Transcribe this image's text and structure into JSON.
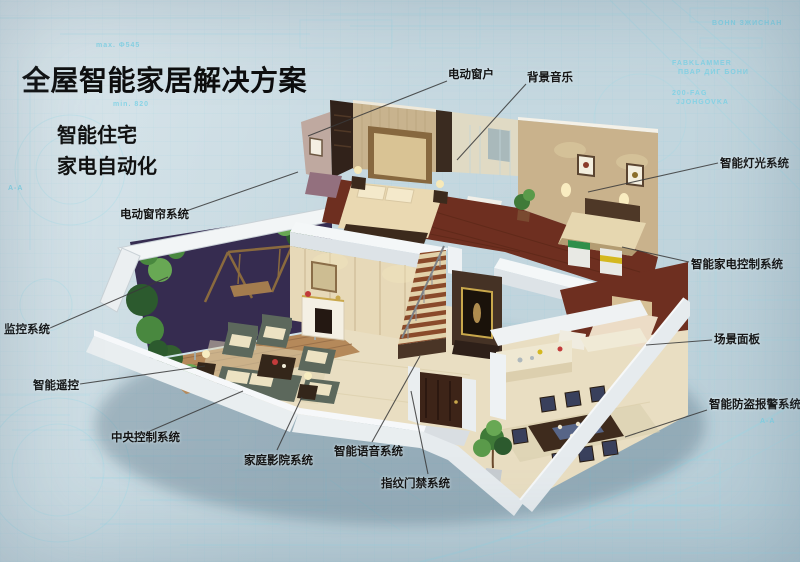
{
  "header": {
    "title": "全屋智能家居解决方案",
    "subtitle_line1": "智能住宅",
    "subtitle_line2": "家电自动化"
  },
  "callouts": [
    {
      "id": "electric-window",
      "label": "电动窗户"
    },
    {
      "id": "background-music",
      "label": "背景音乐"
    },
    {
      "id": "smart-lighting",
      "label": "智能灯光系统"
    },
    {
      "id": "smart-appliance-control",
      "label": "智能家电控制系统"
    },
    {
      "id": "scene-panel",
      "label": "场景面板"
    },
    {
      "id": "burglar-alarm",
      "label": "智能防盗报警系统"
    },
    {
      "id": "electric-curtain",
      "label": "电动窗帘系统"
    },
    {
      "id": "monitoring-system",
      "label": "监控系统"
    },
    {
      "id": "smart-remote",
      "label": "智能遥控"
    },
    {
      "id": "central-control",
      "label": "中央控制系统"
    },
    {
      "id": "home-theater",
      "label": "家庭影院系统"
    },
    {
      "id": "smart-voice",
      "label": "智能语音系统"
    },
    {
      "id": "fingerprint-access",
      "label": "指纹门禁系统"
    }
  ],
  "background": {
    "fragments": [
      "min. 820",
      "max. Φ545",
      "200-FAG",
      "A-A",
      "FABKLAMMER",
      "JJOHGOVKA",
      "BOHN ЗЖИСНАН",
      "ПВАР ДИГ БОНИ",
      "A-A"
    ]
  },
  "colors": {
    "background_base": "#c4d7df",
    "blueprint_line": "#9bdae8",
    "label_text": "#141414",
    "leader_line": "#3a3a3a",
    "wood_floor": "#6e2f20",
    "marble_floor": "#e9dec2",
    "wall_beige": "#c9b28c",
    "white_wall": "#eef1f3",
    "sofa_green": "#5c685c",
    "plant_green": "#49883f",
    "balcony_backdrop": "#362c50"
  }
}
